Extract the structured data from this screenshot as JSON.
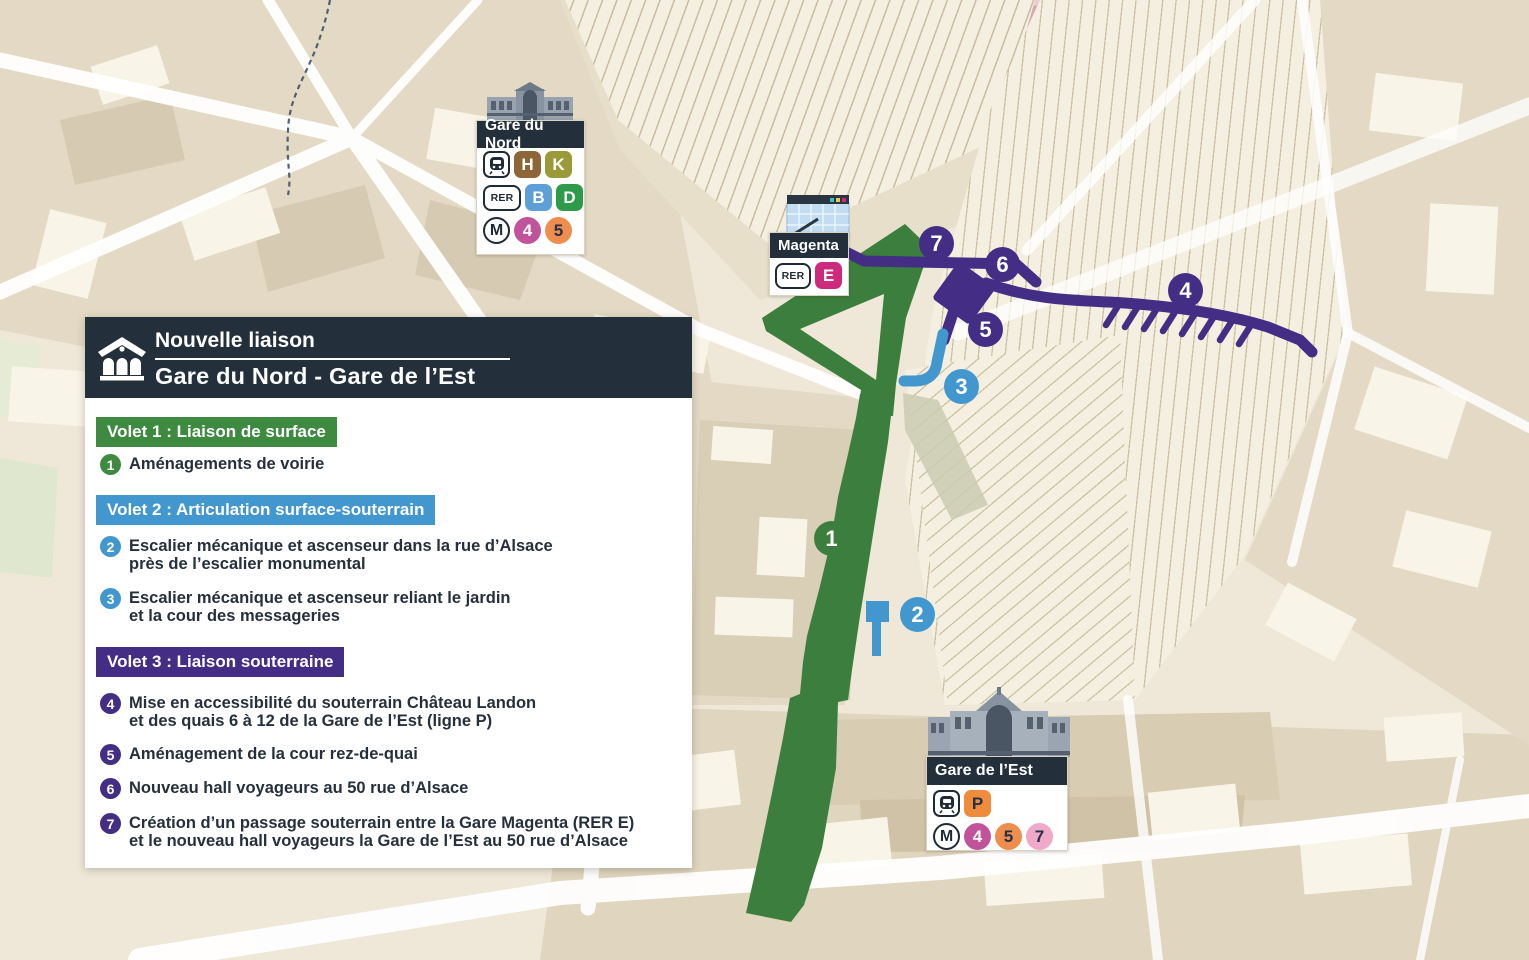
{
  "panel": {
    "header": {
      "line1": "Nouvelle liaison",
      "line2": "Gare du Nord - Gare de l’Est"
    },
    "sections": [
      {
        "label": "Volet 1 : Liaison de surface",
        "color": "#3E8A41",
        "items": [
          {
            "num": "1",
            "color": "#3E8A41",
            "line1": "Aménagements de voirie",
            "line2": ""
          }
        ]
      },
      {
        "label": "Volet 2 : Articulation surface-souterrain",
        "color": "#4397CF",
        "items": [
          {
            "num": "2",
            "color": "#4397CF",
            "line1": "Escalier mécanique et ascenseur dans la rue d’Alsace",
            "line2": "près de l’escalier monumental"
          },
          {
            "num": "3",
            "color": "#4397CF",
            "line1": "Escalier mécanique et ascenseur reliant le jardin",
            "line2": "et la cour des messageries"
          }
        ]
      },
      {
        "label": "Volet 3 : Liaison souterraine",
        "color": "#442D84",
        "items": [
          {
            "num": "4",
            "color": "#442D84",
            "line1": "Mise en accessibilité du souterrain Château Landon",
            "line2": "et des quais 6 à 12 de la Gare de l’Est (ligne P)"
          },
          {
            "num": "5",
            "color": "#442D84",
            "line1": "Aménagement de la cour rez-de-quai",
            "line2": ""
          },
          {
            "num": "6",
            "color": "#442D84",
            "line1": "Nouveau hall voyageurs au 50 rue d’Alsace",
            "line2": ""
          },
          {
            "num": "7",
            "color": "#442D84",
            "line1": "Création d’un passage souterrain entre la Gare Magenta (RER E)",
            "line2": "et le nouveau hall voyageurs la Gare de l’Est au 50 rue d’Alsace"
          }
        ]
      }
    ]
  },
  "stations": {
    "gare_du_nord": {
      "name": "Gare du Nord",
      "transilien_label": "",
      "rer_label": "RER",
      "metro_label": "M",
      "chips": {
        "h": {
          "label": "H",
          "bg": "#8E6538",
          "fg": "#FFFFFF"
        },
        "k": {
          "label": "K",
          "bg": "#9B9A39",
          "fg": "#FFFFFF"
        },
        "b": {
          "label": "B",
          "bg": "#5E9FD8",
          "fg": "#FFFFFF"
        },
        "d": {
          "label": "D",
          "bg": "#2D9B49",
          "fg": "#FFFFFF"
        },
        "m4": {
          "label": "4",
          "bg": "#C0539A",
          "fg": "#FFFFFF"
        },
        "m5": {
          "label": "5",
          "bg": "#EE8D4D",
          "fg": "#253048"
        }
      }
    },
    "magenta": {
      "name": "Magenta",
      "rer_label": "RER",
      "chips": {
        "e": {
          "label": "E",
          "bg": "#CE2A7D",
          "fg": "#FFFFFF"
        }
      }
    },
    "gare_de_l_est": {
      "name": "Gare de l’Est",
      "rer_label": "RER",
      "metro_label": "M",
      "chips": {
        "p": {
          "label": "P",
          "bg": "#EE8C3C",
          "fg": "#253048"
        },
        "m4": {
          "label": "4",
          "bg": "#C0539A",
          "fg": "#FFFFFF"
        },
        "m5": {
          "label": "5",
          "bg": "#EE8D4D",
          "fg": "#253048"
        },
        "m7": {
          "label": "7",
          "bg": "#F0A9C8",
          "fg": "#253048"
        }
      }
    }
  },
  "map": {
    "markers": [
      {
        "num": "1",
        "color": "#3C7E3D"
      },
      {
        "num": "2",
        "color": "#4397CF"
      },
      {
        "num": "3",
        "color": "#4397CF"
      },
      {
        "num": "4",
        "color": "#442D84"
      },
      {
        "num": "5",
        "color": "#442D84"
      },
      {
        "num": "6",
        "color": "#442D84"
      },
      {
        "num": "7",
        "color": "#442D84"
      }
    ],
    "route_colors": {
      "surface": "#3C7E3D",
      "underground": "#442D84",
      "connector": "#4397CF"
    }
  }
}
